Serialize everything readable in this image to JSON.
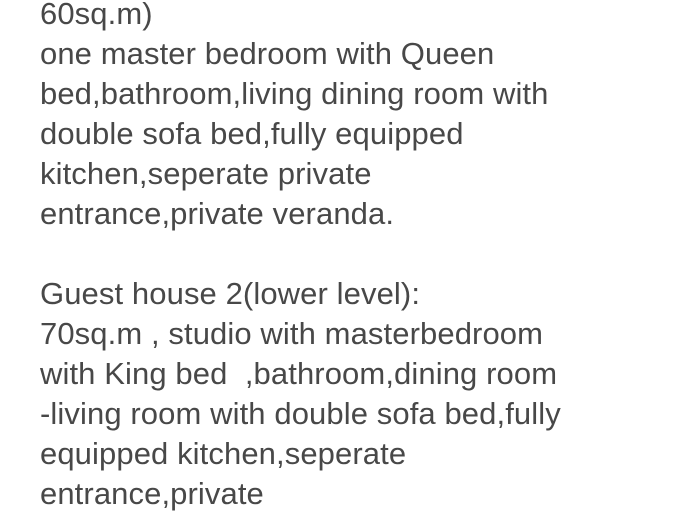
{
  "page": {
    "background_color": "#ffffff",
    "text_color": "#484848"
  },
  "description": {
    "lines": [
      "60sq.m)",
      "one master bedroom with Queen",
      "bed,bathroom,living dining room with",
      "double sofa bed,fully equipped",
      "kitchen,seperate private",
      "entrance,private veranda.",
      "",
      "Guest house 2(lower level):",
      "70sq.m , studio with masterbedroom",
      "with King bed  ,bathroom,dining room",
      "-living room with double sofa bed,fully",
      "equipped kitchen,seperate",
      "entrance,private"
    ]
  }
}
